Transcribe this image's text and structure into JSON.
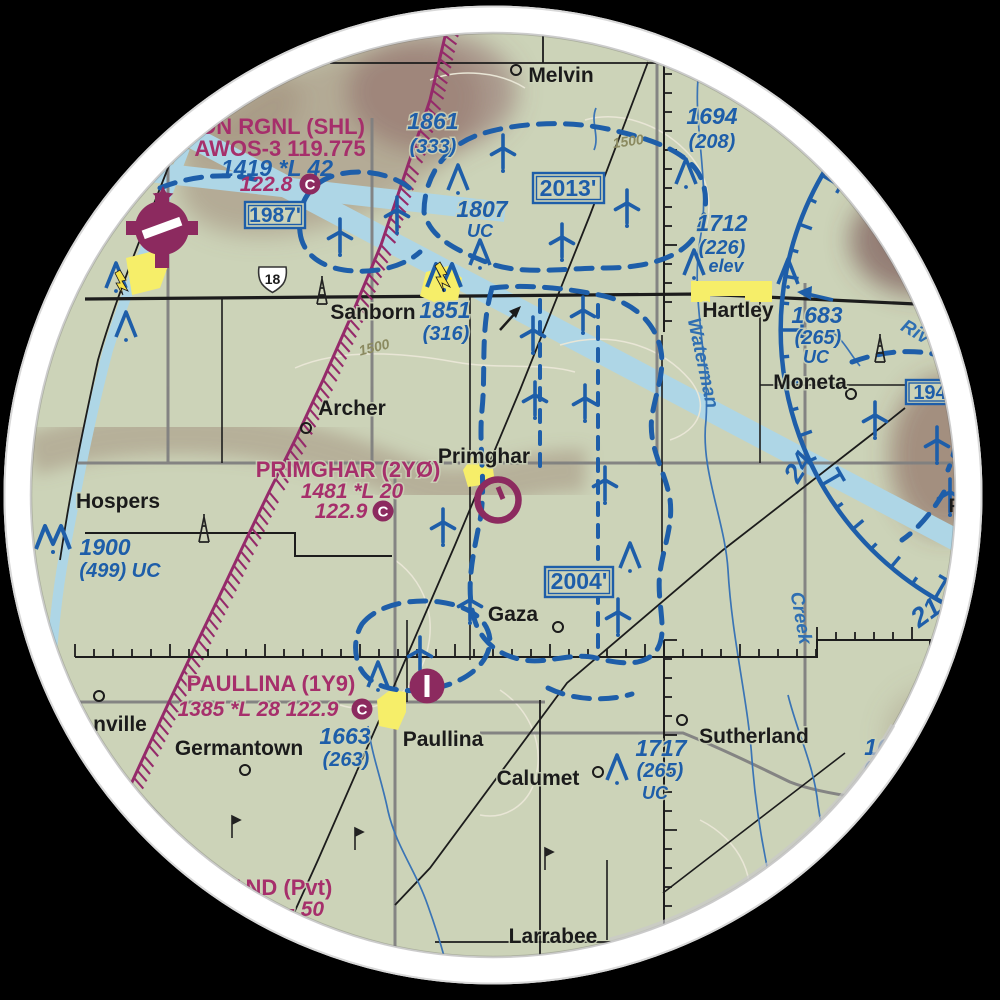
{
  "colors": {
    "map_background": "#ccd3b8",
    "chart_blue": "#1e5ea9",
    "magenta_text": "#a62f6b",
    "maroon_symbol": "#8c2a5f",
    "town_yellow": "#f6ee69",
    "airway_blue": "#aed6e6",
    "stream_blue": "#3a74b5",
    "road_gray": "#7f7f7f",
    "road_black": "#1c1c1c",
    "relief_brown": "#9b8474",
    "contour_line": "#e9e6d6",
    "ring_white": "#ffffff",
    "outside": "#000000"
  },
  "airports": {
    "sheldon": {
      "name": "ON RGNL (SHL)",
      "awos": "AWOS-3 119.775",
      "elev_lighting": "1419 *L 42",
      "freq": "122.8",
      "freq_c": "C",
      "mef_box": "1987'"
    },
    "primghar": {
      "name": "PRIMGHAR (2YØ)",
      "elev_lighting": "1481 *L 20",
      "freq": "122.9",
      "freq_c": "C"
    },
    "paullina": {
      "name": "PAULLINA (1Y9)",
      "elev_lighting_freq": "1385 *L 28 122.9",
      "freq_c": "C"
    },
    "private_partial": {
      "name": "AND (Pvt)",
      "data": "- 50"
    }
  },
  "towns": {
    "melvin": "Melvin",
    "sanborn": "Sanborn",
    "hartley": "Hartley",
    "moneta": "Moneta",
    "archer": "Archer",
    "hospers": "Hospers",
    "primghar": "Primghar",
    "gaza": "Gaza",
    "germantown": "Germantown",
    "paullina": "Paullina",
    "calumet": "Calumet",
    "sutherland": "Sutherland",
    "larrabee": "Larrabee",
    "granville_partial": "nville",
    "partial_p": "P"
  },
  "obstacles": {
    "o1861": {
      "elev": "1861",
      "agl": "(333)"
    },
    "o1694": {
      "elev": "1694",
      "agl": "(208)"
    },
    "o1807": {
      "elev": "1807",
      "note": "UC"
    },
    "o1712": {
      "elev": "1712",
      "agl": "(226)",
      "note": "elev"
    },
    "o1851": {
      "elev": "1851",
      "agl": "(316)"
    },
    "o1683": {
      "elev": "1683",
      "agl": "(265)",
      "note": "UC"
    },
    "o1719": {
      "elev": "1719",
      "agl": "(345)",
      "note": "UC"
    },
    "o1900": {
      "elev": "1900",
      "agl": "(499) UC"
    },
    "o1717": {
      "elev": "1717",
      "agl": "(265)",
      "note": "UC"
    },
    "o1663": {
      "elev": "1663",
      "agl": "(263)"
    },
    "o16xx": {
      "elev": "16",
      "agl": "(2"
    }
  },
  "mef_boxes": {
    "b2013": "2013'",
    "b2004": "2004'",
    "b194": "194"
  },
  "compass": {
    "radial_24": "24",
    "radial_21": "21"
  },
  "hydrography": {
    "waterman": "Waterman",
    "creek": "Creek",
    "river_partial": "Riv"
  },
  "contours": {
    "c1500": "1500"
  },
  "roads": {
    "us18": "18"
  },
  "symbols": {
    "wind_turbine": "wind-turbine-icon",
    "obstruction": "obstruction-icon",
    "group_obstruction": "group-obstruction-icon",
    "tower": "tower-icon",
    "town_circle": "town-circle-icon",
    "airport_circle": "airport-circle-icon",
    "airport_disc": "airport-disc-icon",
    "beacon_star": "beacon-star-icon",
    "route_shield": "us-route-shield-icon",
    "compass_rose": "vor-compass-rose-arc"
  }
}
